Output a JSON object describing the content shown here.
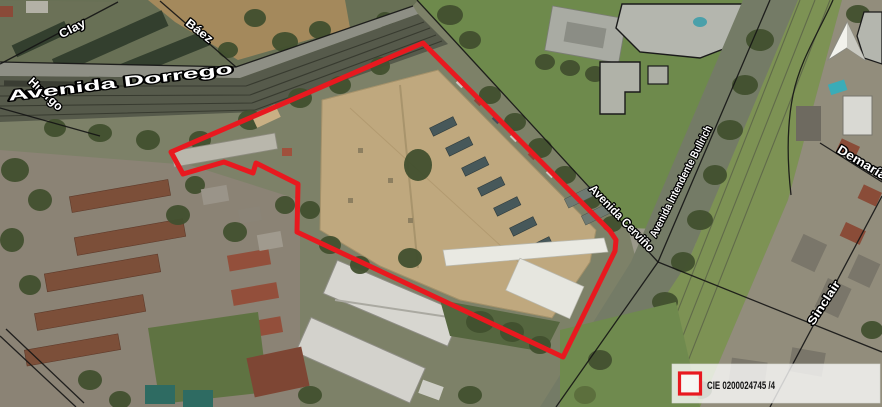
{
  "map": {
    "streets": {
      "clay": "Clay",
      "baez": "Báez",
      "huergo": "Huergo",
      "dorrego": "Avenida Dorrego",
      "cervino": "Avenida Cerviño",
      "bullrich": "Avenida Intendente Bullrich",
      "demaria": "Demaría",
      "sinclair": "Sinclair"
    },
    "parcel": {
      "points": "423,43 610,231 616,240 615,251 563,357 297,232 298,184 256,163 253,173 224,162 183,174 171,152",
      "color": "#e8191f"
    },
    "legend": {
      "code": "CIE 0200024745 /4",
      "swatch_color": "#e8191f"
    },
    "icons": {
      "north_arrow": "north-arrow-icon"
    },
    "colors": {
      "label_fill": "#ffffff",
      "label_outline": "#000000",
      "street_line": "#141414",
      "legend_background": "rgba(255,255,255,0.78)"
    }
  }
}
